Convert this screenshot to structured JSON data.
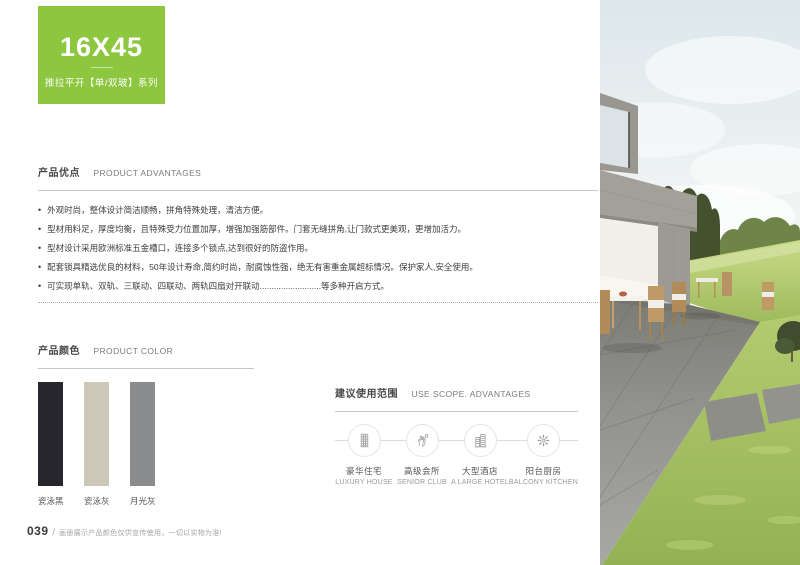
{
  "header": {
    "series_code": "16X45",
    "series_name": "推拉平开【单/双玻】系列",
    "accent_color": "#8dc63f"
  },
  "advantages": {
    "title_cn": "产品优点",
    "title_en": "PRODUCT ADVANTAGES",
    "bullets": [
      "外观时尚，整体设计简洁顺畅，拼角特殊处理，清洁方便。",
      "型材用料足，厚度均衡，且特殊受力位置加厚，增强加强筋部件。门套无缝拼角,让门款式更美观，更增加活力。",
      "型材设计采用欧洲标准五金槽口，连接多个锁点,达到很好的防盗作用。",
      "配套锁具精选优良的材料，50年设计寿命,简约时尚，耐腐蚀性强，绝无有害重金属超标情况。保护家人,安全使用。",
      "可实现单轨、双轨、三联动、四联动、两轨四扇对开联动..........................等多种开启方式。"
    ]
  },
  "colors": {
    "title_cn": "产品颜色",
    "title_en": "PRODUCT COLOR",
    "swatches": [
      {
        "name": "瓷泳黑",
        "hex": "#26262c"
      },
      {
        "name": "瓷泳灰",
        "hex": "#ccc7b6"
      },
      {
        "name": "月光灰",
        "hex": "#8b8c8e"
      }
    ]
  },
  "use_scope": {
    "title_cn": "建议使用范围",
    "title_en": "USE SCOPE. ADVANTAGES",
    "items": [
      {
        "icon": "luxury-house-icon",
        "label_cn": "豪华住宅",
        "label_en": "LUXURY HOUSE"
      },
      {
        "icon": "senior-club-icon",
        "label_cn": "高级会所",
        "label_en": "SENIOR CLUB"
      },
      {
        "icon": "large-hotel-icon",
        "label_cn": "大型酒店",
        "label_en": "A LARGE HOTEL"
      },
      {
        "icon": "balcony-kitchen-icon",
        "label_cn": "阳台厨房",
        "label_en": "BALCONY KITCHEN"
      }
    ]
  },
  "footer": {
    "page_number": "039",
    "separator": "/",
    "note": "画册展示产品颜色仅供宣传使用，一切以实物为准!"
  }
}
